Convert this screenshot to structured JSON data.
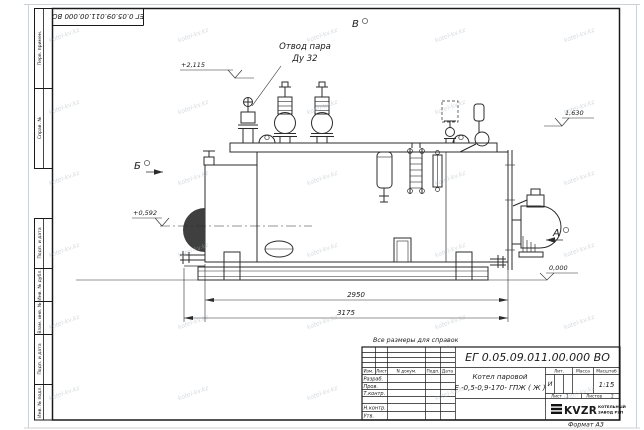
{
  "doc": {
    "designation": "ЕГ 0.05.09.011.00.000  ВО"
  },
  "watermark": {
    "text": "kotel-kv.kz"
  },
  "margin_stamps": {
    "top": [
      "Перв. примен.",
      "Справ. №"
    ],
    "bottom": [
      "Подп. и дата",
      "Инв. № дубл.",
      "Взам. инв. №",
      "Подп. и дата",
      "Инв. № подл."
    ]
  },
  "drawing": {
    "callout": {
      "line1": "Отвод пара",
      "line2": "Ду 32"
    },
    "views": {
      "top": "В",
      "left": "Б",
      "right": "А"
    },
    "elevations": {
      "valves_top": "+2,115",
      "boiler_top": "1,630",
      "burner_axis": "+0,592",
      "ground": "0,000"
    },
    "dimensions": {
      "shell_length": "2950",
      "overall_length": "3175"
    }
  },
  "title_block": {
    "note": "Все размеры для справок",
    "name_line1": "Котел паровой",
    "name_line2": "Е -0,5-0,9-170- ГПЖ ( Ж )",
    "rev_headers": [
      "Изм.",
      "Лист",
      "N докум.",
      "Подп.",
      "Дата"
    ],
    "sign_rows": [
      "Разраб.",
      "Пров.",
      "Т.контр.",
      "Н.контр.",
      "Утв."
    ],
    "lit_header": "Лит.",
    "lit_value": "И",
    "mass_header": "Масса",
    "scale_header": "Масштаб",
    "scale_value": "1:15",
    "sheet_label": "Лист",
    "sheet_value": "1",
    "sheets_label": "Листов",
    "sheets_value": "2",
    "org_logo": "KVZR",
    "org_name_line1": "КОТЕЛЬНЫЙ",
    "org_name_line2": "ЗАВОД РЭП",
    "format_label": "Формат А3"
  }
}
